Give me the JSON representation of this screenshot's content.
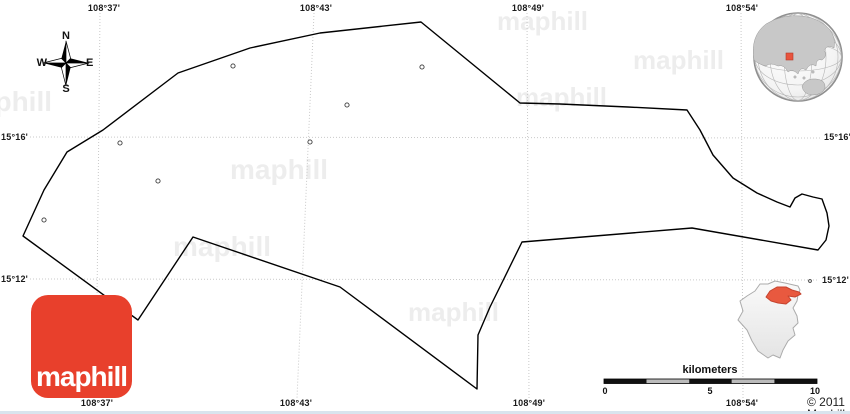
{
  "grid": {
    "top": [
      "108°37'",
      "108°43'",
      "108°49'",
      "108°54'"
    ],
    "bottom": [
      "108°37'",
      "108°43'",
      "108°49'",
      "108°54'"
    ],
    "left": [
      "15°16'",
      "15°12'"
    ],
    "right": [
      "15°16'",
      "15°12'"
    ]
  },
  "compass": {
    "north": "N",
    "east": "E",
    "south": "S",
    "west": "W"
  },
  "scale_bar": {
    "label": "kilometers",
    "ticks": [
      "0",
      "5",
      "10"
    ]
  },
  "branding": {
    "logo_text": "maphill",
    "watermark_text": "maphill",
    "copyright": "© 2011 Maphill"
  },
  "colors": {
    "logo_red": "#e8402c",
    "inset_highlight_red": "#e8593f",
    "globe_marker_red": "#e8543e",
    "boundary_black": "#000000",
    "gridline_gray": "#c9c9c9"
  }
}
